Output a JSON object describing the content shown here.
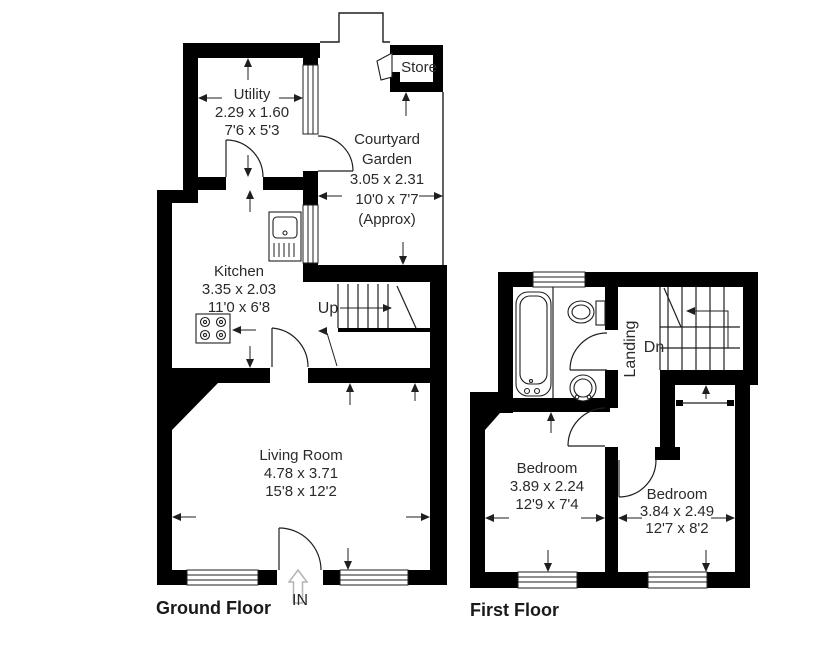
{
  "page": {
    "background": "#ffffff"
  },
  "colors": {
    "wall": "#000000",
    "line": "#1f1f1f",
    "text": "#2a2a2a",
    "entrance_arrow": "#b4b4b4"
  },
  "floors": {
    "ground": {
      "label": "Ground Floor"
    },
    "first": {
      "label": "First Floor"
    }
  },
  "rooms": {
    "utility": {
      "name": "Utility",
      "metric": "2.29 x 1.60",
      "imperial": "7'6 x 5'3"
    },
    "courtyard": {
      "name_line1": "Courtyard",
      "name_line2": "Garden",
      "metric": "3.05 x 2.31",
      "imperial": "10'0 x 7'7",
      "approx": "(Approx)"
    },
    "store": {
      "name": "Store"
    },
    "kitchen": {
      "name": "Kitchen",
      "metric": "3.35 x 2.03",
      "imperial": "11'0 x 6'8"
    },
    "living_room": {
      "name": "Living Room",
      "metric": "4.78 x 3.71",
      "imperial": "15'8 x 12'2"
    },
    "landing": {
      "name": "Landing"
    },
    "bedroom_1": {
      "name": "Bedroom",
      "metric": "3.89 x 2.24",
      "imperial": "12'9 x 7'4"
    },
    "bedroom_2": {
      "name": "Bedroom",
      "metric": "3.84 x 2.49",
      "imperial": "12'7 x 8'2"
    }
  },
  "stairs": {
    "up_label": "Up",
    "down_label": "Dn"
  },
  "entrance": {
    "label": "IN"
  }
}
